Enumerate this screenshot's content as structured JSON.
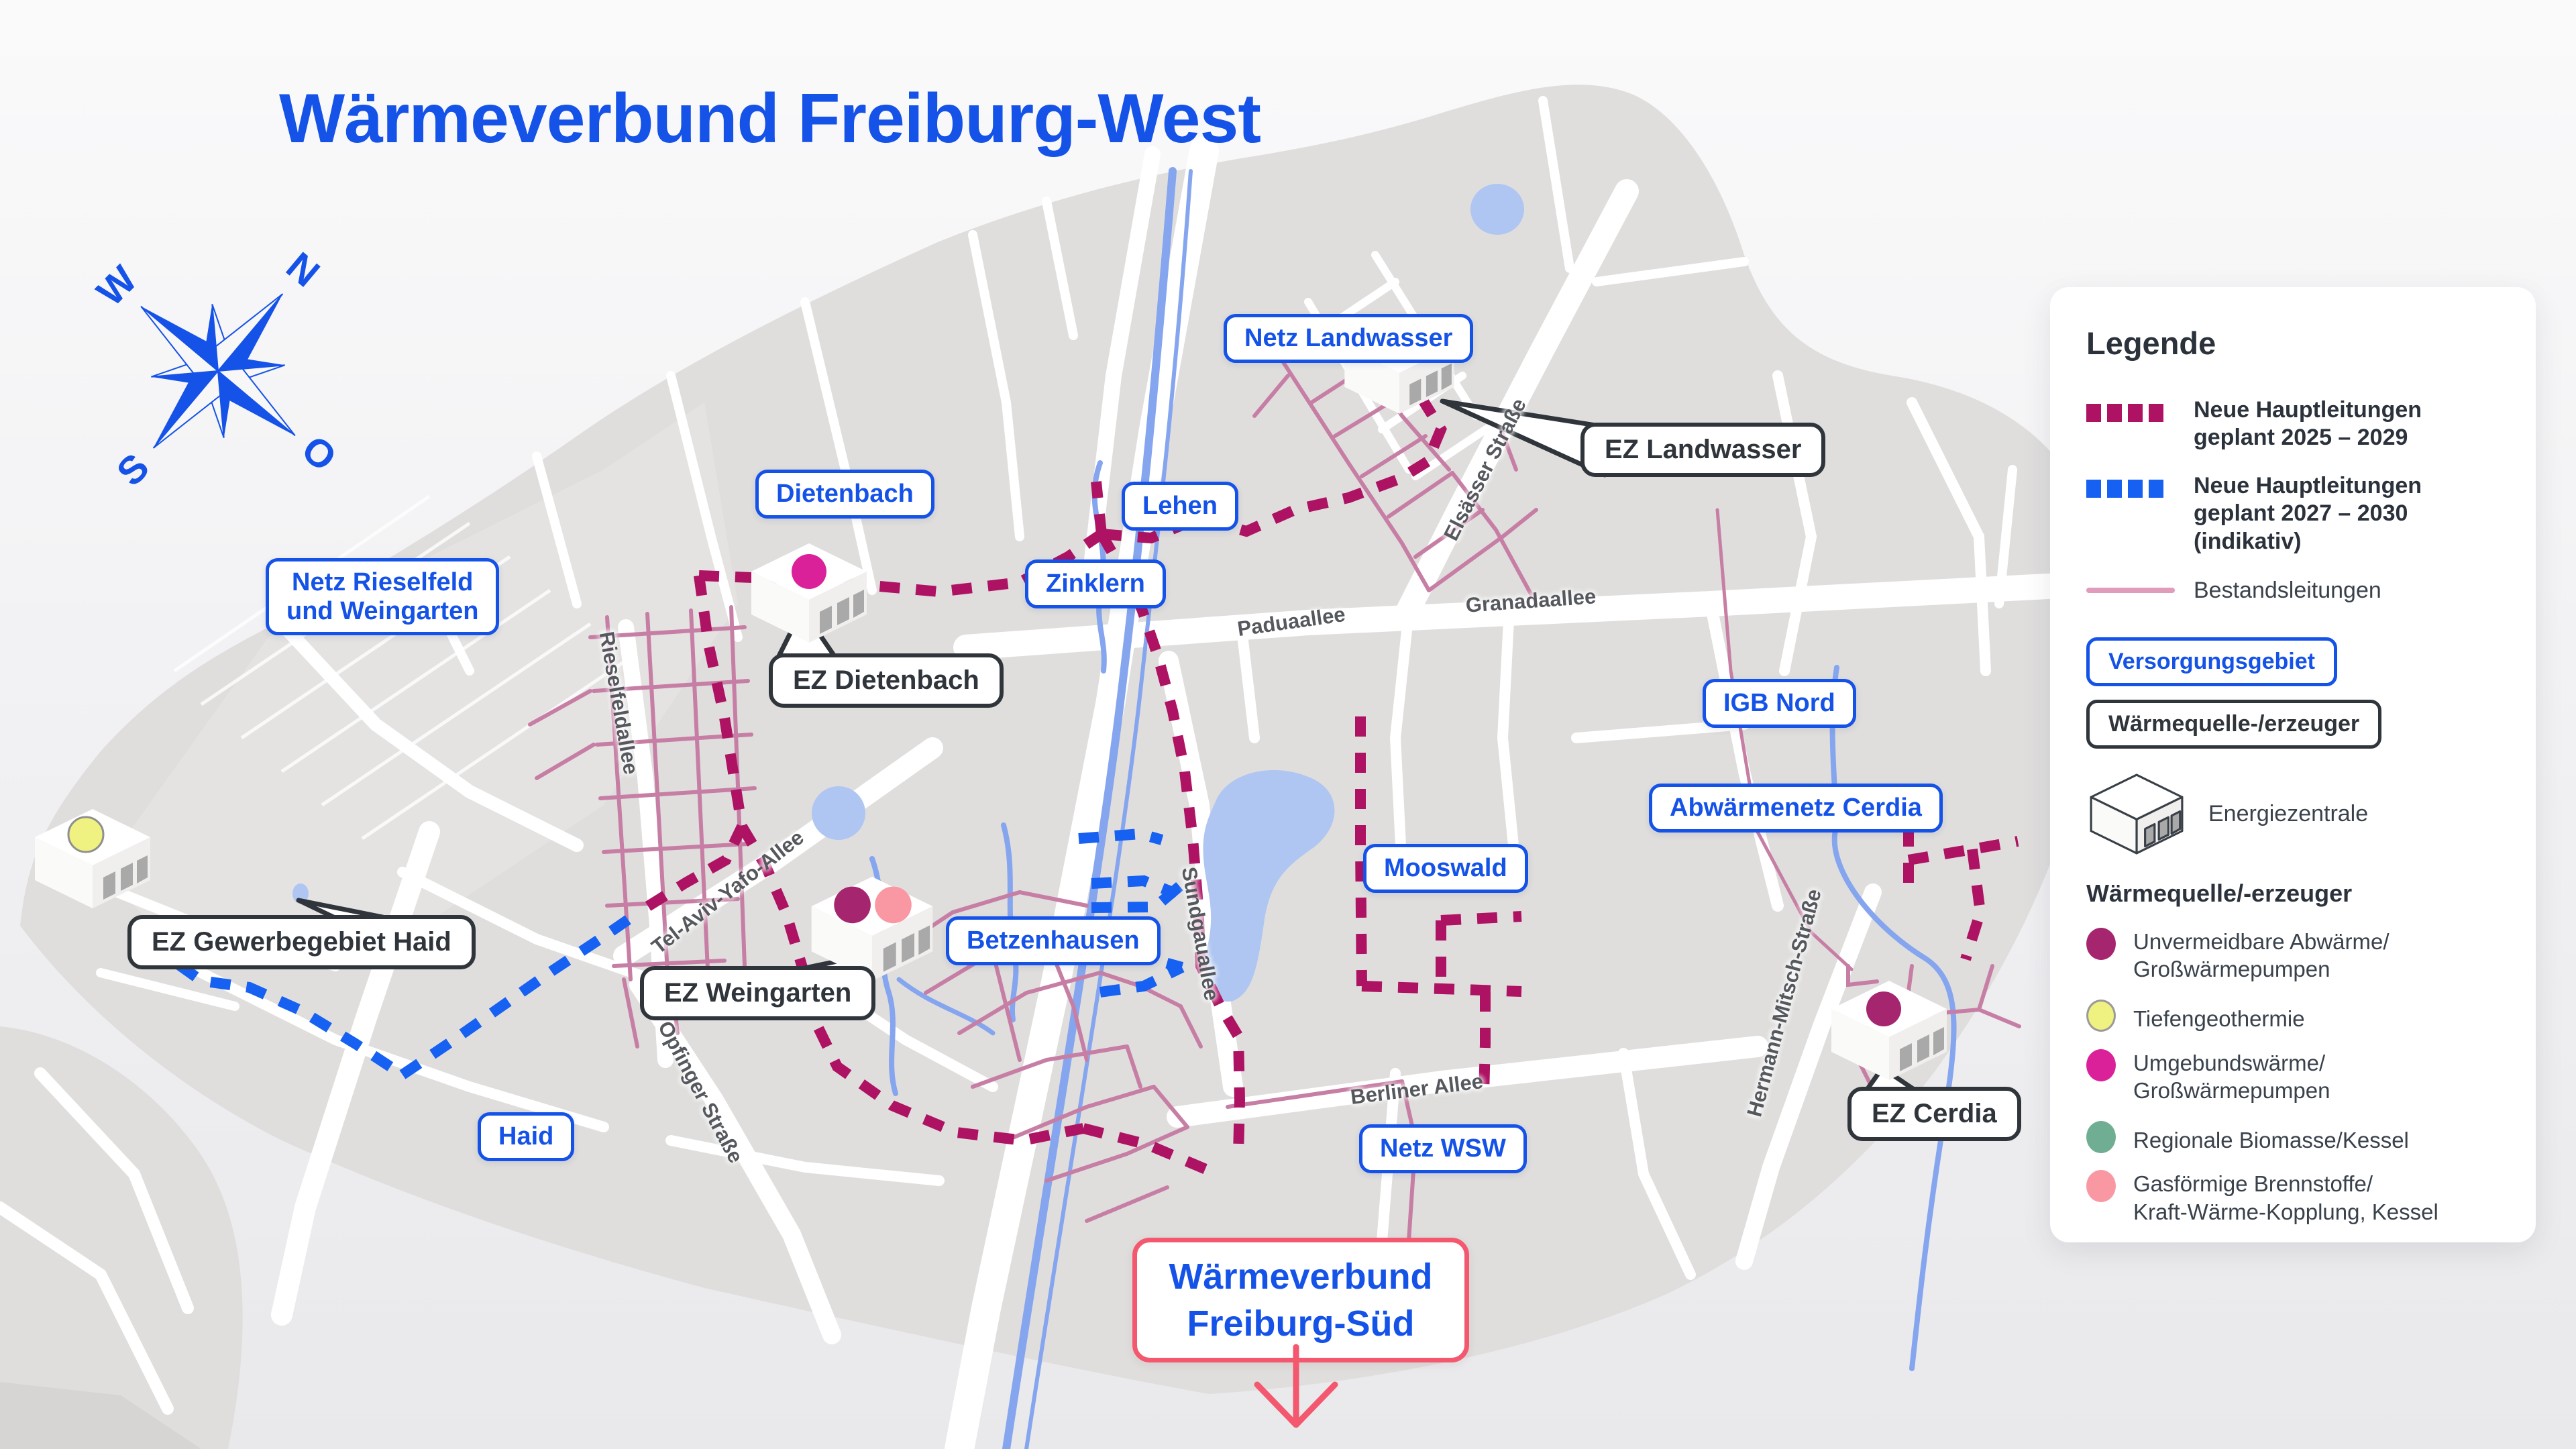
{
  "title": "Wärmeverbund Freiburg-West",
  "compass": {
    "n": "N",
    "o": "O",
    "s": "S",
    "w": "W"
  },
  "legend": {
    "heading": "Legende",
    "lines": [
      {
        "text": "Neue Hauptleitungen",
        "text2": "geplant 2025 – 2029",
        "color": "#AD1263",
        "style": "dashed"
      },
      {
        "text": "Neue Hauptleitungen",
        "text2": "geplant 2027 – 2030 (indikativ)",
        "color": "#1660F2",
        "style": "dashed"
      },
      {
        "text": "Bestandsleitungen",
        "text2": "",
        "color": "#E09CBB",
        "style": "solid"
      }
    ],
    "area_box_label": "Versorgungsgebiet",
    "source_box_label": "Wärmequelle-/erzeuger",
    "plant_label": "Energiezentrale",
    "sources_heading": "Wärmequelle/-erzeuger",
    "sources": [
      {
        "text": "Unvermeidbare Abwärme/",
        "text2": "Großwärmepumpen",
        "color": "#A6256F"
      },
      {
        "text": "Tiefengeothermie",
        "text2": "",
        "color": "#EFF180"
      },
      {
        "text": "Umgebundswärme/",
        "text2": "Großwärmepumpen",
        "color": "#DB219A"
      },
      {
        "text": "Regionale Biomasse/Kessel",
        "text2": "",
        "color": "#6FAE92"
      },
      {
        "text": "Gasförmige Brennstoffe/",
        "text2": "Kraft-Wärme-Kopplung, Kessel",
        "color": "#F998A2"
      }
    ]
  },
  "map": {
    "area_labels": [
      {
        "text": "Netz Landwasser"
      },
      {
        "text": "Dietenbach"
      },
      {
        "text": "Lehen"
      },
      {
        "text": "Zinklern"
      },
      {
        "text": "Netz Rieselfeld",
        "text2": "und Weingarten"
      },
      {
        "text": "IGB Nord"
      },
      {
        "text": "Abwärmenetz Cerdia"
      },
      {
        "text": "Mooswald"
      },
      {
        "text": "Betzenhausen"
      },
      {
        "text": "Haid"
      },
      {
        "text": "Netz WSW"
      }
    ],
    "callouts": [
      {
        "text": "EZ Landwasser"
      },
      {
        "text": "EZ Dietenbach"
      },
      {
        "text": "EZ Gewerbegebiet Haid"
      },
      {
        "text": "EZ Weingarten"
      },
      {
        "text": "EZ Cerdia"
      }
    ],
    "streets": [
      {
        "text": "Elsässer Straße"
      },
      {
        "text": "Granadaallee"
      },
      {
        "text": "Paduaallee"
      },
      {
        "text": "Rieselfeldallee"
      },
      {
        "text": "Tel-Aviv-Yafo-Allee"
      },
      {
        "text": "Sundgauallee"
      },
      {
        "text": "Opfinger Straße"
      },
      {
        "text": "Berliner Allee"
      },
      {
        "text": "Hermann-Mitsch-Straße"
      }
    ]
  },
  "south_link": {
    "text": "Wärmeverbund",
    "text2": "Freiburg-Süd"
  },
  "colors": {
    "accent_blue": "#1452E8",
    "route_2025": "#AD1263",
    "route_2027": "#1660F2",
    "existing_lines": "#C77EA4",
    "south_red": "#F4586E",
    "water": "#85A5EF",
    "lake": "#AEC6F1",
    "land": "#DFDEDD"
  }
}
